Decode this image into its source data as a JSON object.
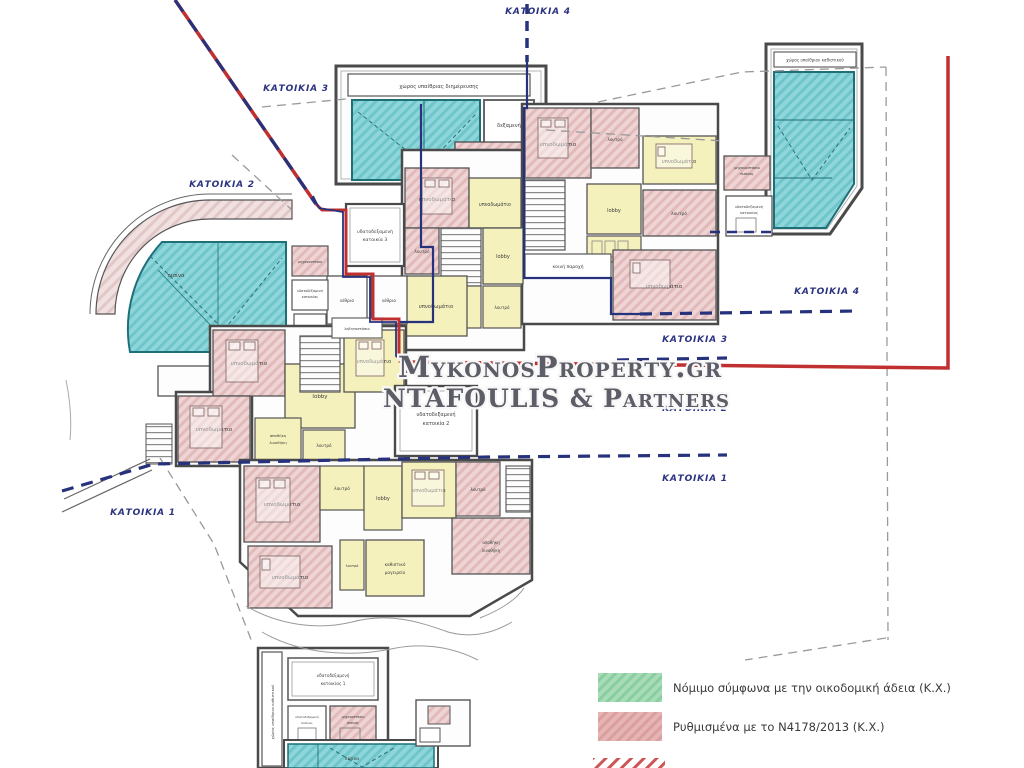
{
  "watermark": {
    "line1": "MykonosProperty.gr",
    "line2": "NTAFOULIS & Partners"
  },
  "zones": {
    "residence_1": "ΚΑΤΟΙΚΙΑ 1",
    "residence_2": "ΚΑΤΟΙΚΙΑ 2",
    "residence_3": "ΚΑΤΟΙΚΙΑ 3",
    "residence_4": "ΚΑΤΟΙΚΙΑ 4"
  },
  "rooms": {
    "bedroom": "υπνοδωμάτιο",
    "lobby": "lobby",
    "bathroom": "λουτρό",
    "pool": "πισίνα",
    "tank": "δεξαμενή",
    "atrium": "αίθριο",
    "machine_room": "μηχανοστάσιο",
    "pool_machine_l1": "μηχανοστάσιο",
    "pool_machine_l2": "πισίνας",
    "water_tank": "υδατοδεξαμενή",
    "house1": "κατοικίας 1",
    "house2": "κατοικία 2",
    "house3": "κατοικία 3",
    "house_generic": "κατοικίας",
    "pool_gen": "πισίνας",
    "storage_l1": "αποθήκη",
    "storage_l2": "λινοθήκη",
    "living_l1": "καθιστικό",
    "living_l2": "μαγειρείο",
    "outdoor_living": "χώρος υπαίθριας διημέρευσης",
    "outdoor_sitting": "χώρος υπαίθριου καθιστικού",
    "boiler": "λεβητοστάσιο",
    "common": "κοινή παροχή"
  },
  "legend": {
    "items": [
      {
        "label": "Νόμιμο σύμφωνα με την οικοδομική άδεια (Κ.Χ.)",
        "fill": "#a8dcb8",
        "hatch": "#74c48e"
      },
      {
        "label": "Ρυθμισμένα με το Ν4178/2013 (Κ.Χ.)",
        "fill": "#e5b5b5",
        "hatch": "#d49090"
      }
    ]
  },
  "colors": {
    "boundary_red": "#c03030",
    "division_blue": "#27327d",
    "pool_cyan": "#8fd6da",
    "room_pink": "#eed4d4",
    "room_yellow": "#f5f1bd",
    "projection_gray": "#9a9a9a"
  }
}
